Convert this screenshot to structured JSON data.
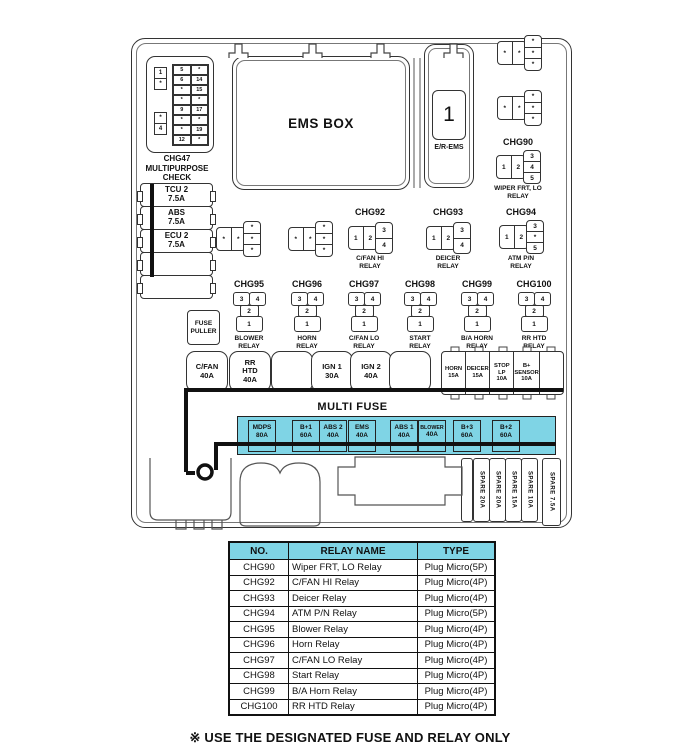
{
  "note": "※ USE THE DESIGNATED FUSE AND RELAY ONLY",
  "colors": {
    "highlight": "#7fd4e5",
    "line": "#333333"
  },
  "star": "*",
  "connector": {
    "label": {
      "l1": "CHG47",
      "l2": "MULTIPURPOSE",
      "l3": "CHECK",
      "l4": "CONNECTOR"
    },
    "side_pins": [
      "1",
      "*",
      "*",
      "4"
    ],
    "grid": [
      [
        "5",
        "*"
      ],
      [
        "6",
        "14"
      ],
      [
        "*",
        "15"
      ],
      [
        "*",
        "*"
      ],
      [
        "9",
        "17"
      ],
      [
        "*",
        "*"
      ],
      [
        "*",
        "19"
      ],
      [
        "12",
        "*"
      ]
    ]
  },
  "ems": {
    "title": "EMS BOX",
    "slot": "1",
    "slot_label": "E/R-EMS"
  },
  "left_fuse_column": [
    {
      "l1": "TCU 2",
      "l2": "7.5A"
    },
    {
      "l1": "ABS",
      "l2": "7.5A"
    },
    {
      "l1": "ECU 2",
      "l2": "7.5A"
    },
    {},
    {}
  ],
  "fuse_puller": {
    "l1": "FUSE",
    "l2": "PULLER"
  },
  "relays_b": {
    "chg90": {
      "id": "CHG90",
      "h": [
        "1",
        "2"
      ],
      "v": [
        "3",
        "4",
        "5"
      ],
      "n1": "WIPER FRT, LO",
      "n2": "RELAY"
    },
    "chg92": {
      "id": "CHG92",
      "h": [
        "1",
        "2"
      ],
      "v": [
        "3",
        "4"
      ],
      "n1": "C/FAN HI",
      "n2": "RELAY"
    },
    "chg93": {
      "id": "CHG93",
      "h": [
        "1",
        "2"
      ],
      "v": [
        "3",
        "4"
      ],
      "n1": "DEICER",
      "n2": "RELAY"
    },
    "chg94": {
      "id": "CHG94",
      "h": [
        "1",
        "2"
      ],
      "v": [
        "3",
        "*",
        "5"
      ],
      "n1": "ATM P/N",
      "n2": "RELAY"
    }
  },
  "relay_c_pins": {
    "tl": "3",
    "tr": "4",
    "m": "2",
    "b": "1"
  },
  "relays_c": [
    {
      "id": "CHG95",
      "n1": "BLOWER",
      "n2": "RELAY"
    },
    {
      "id": "CHG96",
      "n1": "HORN",
      "n2": "RELAY"
    },
    {
      "id": "CHG97",
      "n1": "C/FAN LO",
      "n2": "RELAY"
    },
    {
      "id": "CHG98",
      "n1": "START",
      "n2": "RELAY"
    },
    {
      "id": "CHG99",
      "n1": "B/A HORN",
      "n2": "RELAY"
    },
    {
      "id": "CHG100",
      "n1": "RR HTD",
      "n2": "RELAY"
    }
  ],
  "big_fuses": [
    {
      "l1": "C/FAN",
      "l2": "40A"
    },
    {
      "l1": "RR",
      "l2": "HTD",
      "l3": "40A"
    },
    {},
    {
      "l1": "IGN 1",
      "l2": "30A"
    },
    {
      "l1": "IGN 2",
      "l2": "40A"
    },
    {}
  ],
  "small_fuses": [
    {
      "l1": "HORN",
      "l2": "15A"
    },
    {
      "l1": "DEICER",
      "l2": "15A"
    },
    {
      "l1": "STOP",
      "l2": "LP",
      "l3": "10A"
    },
    {
      "l1": "B+",
      "l2": "SENSOR",
      "l3": "10A"
    },
    {}
  ],
  "multi_fuse": {
    "title": "MULTI FUSE",
    "items": [
      {
        "name": "MDPS",
        "amp": "80A"
      },
      {
        "name": "B+1",
        "amp": "60A"
      },
      {
        "name": "ABS 2",
        "amp": "40A"
      },
      {
        "name": "EMS",
        "amp": "40A"
      },
      {
        "name": "ABS 1",
        "amp": "40A"
      },
      {
        "name": "BLOWER",
        "amp": "40A"
      },
      {
        "name": "B+3",
        "amp": "60A"
      },
      {
        "name": "B+2",
        "amp": "60A"
      }
    ]
  },
  "spares": [
    "SPARE 20A",
    "SPARE 20A",
    "SPARE 15A",
    "SPARE 10A",
    "SPARE 7.5A"
  ],
  "table": {
    "headers": [
      "NO.",
      "RELAY NAME",
      "TYPE"
    ],
    "rows": [
      [
        "CHG90",
        "Wiper FRT, LO Relay",
        "Plug Micro(5P)"
      ],
      [
        "CHG92",
        "C/FAN HI Relay",
        "Plug Micro(4P)"
      ],
      [
        "CHG93",
        "Deicer Relay",
        "Plug Micro(4P)"
      ],
      [
        "CHG94",
        "ATM P/N Relay",
        "Plug Micro(5P)"
      ],
      [
        "CHG95",
        "Blower Relay",
        "Plug Micro(4P)"
      ],
      [
        "CHG96",
        "Horn Relay",
        "Plug Micro(4P)"
      ],
      [
        "CHG97",
        "C/FAN LO Relay",
        "Plug Micro(4P)"
      ],
      [
        "CHG98",
        "Start Relay",
        "Plug Micro(4P)"
      ],
      [
        "CHG99",
        "B/A Horn Relay",
        "Plug Micro(4P)"
      ],
      [
        "CHG100",
        "RR HTD Relay",
        "Plug Micro(4P)"
      ]
    ]
  }
}
